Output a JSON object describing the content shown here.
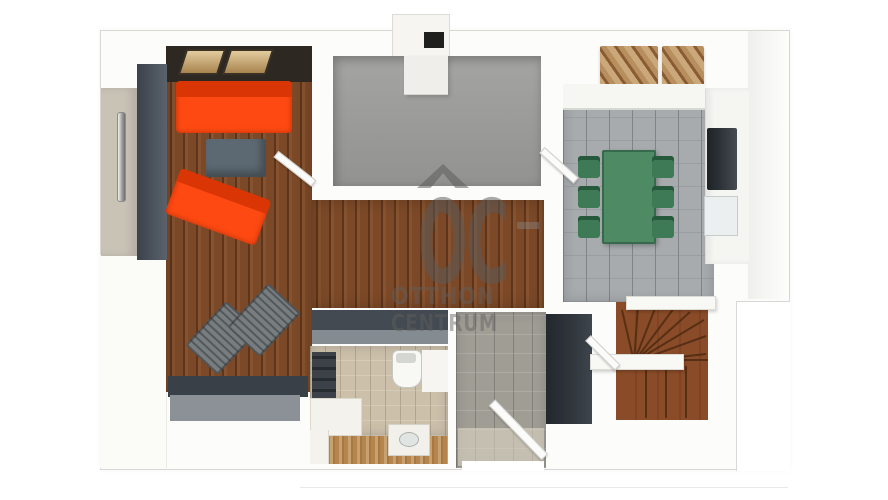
{
  "watermark": {
    "logo": "OC",
    "line1": "OTTHON",
    "line2": "CENTRUM",
    "roof_icon": "roof-chevron"
  },
  "colors": {
    "outline-gray": "#d8d7d3",
    "wall-white": "#fbfbf9",
    "wall-band-dark": "#2e2822",
    "wood-floor": "#7b4928",
    "bath-wood": "#b5854d",
    "stair-wood": "#8a4c28",
    "gray-room-floor": "#9b9b99",
    "kitchen-tile": "#a7abad",
    "hall-tile": "#a09d95",
    "bath-tile": "#ccc0aa",
    "sofa-orange": "#fe4a12",
    "sofa-back": "#d93505",
    "coffee-table-gray": "#5d6972",
    "lounge-gray": "#787d80",
    "rug-dark": "#3a4047",
    "rug-gray": "#8b9197",
    "wardrobe-dark": "#424a53",
    "hall-wardrobe-dark": "#31373d",
    "dark-band": "#434a51",
    "table-green": "#4e8b65",
    "chair-green": "#3d7a55",
    "appliance-dark": "#2b3136",
    "cabinet-wood-tan": "#caa87a",
    "door-panel-greige": "#c9c3b6",
    "skylight-tan": "#c9ad7e",
    "chimney-dark": "#1f1f1d",
    "watermark-gray": "#5f5f5f"
  },
  "legend": {
    "rooms": [
      "living-room",
      "gray-room",
      "kitchen-dining",
      "corridor",
      "hallway",
      "bathroom",
      "staircase"
    ],
    "furniture": [
      "orange-sofa",
      "orange-sofa-angled",
      "coffee-table",
      "lounge-chair",
      "lounge-chair",
      "wardrobe",
      "dining-table",
      "dining-chair-x6",
      "kitchen-counter",
      "appliance",
      "hall-wardrobe",
      "washer",
      "toilet",
      "vanity-sink",
      "winder-stairs"
    ]
  }
}
